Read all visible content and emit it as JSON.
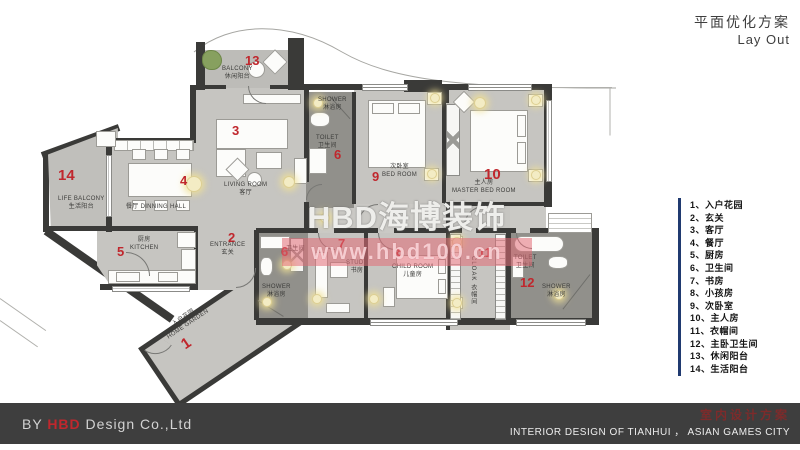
{
  "title": {
    "cn": "平面优化方案",
    "en": "Lay Out"
  },
  "watermark": {
    "brand": "HBD海博装饰",
    "url": "www.hbd100.cn"
  },
  "legend": {
    "items": [
      {
        "n": "1、",
        "t": "入户花园"
      },
      {
        "n": "2、",
        "t": "玄关"
      },
      {
        "n": "3、",
        "t": "客厅"
      },
      {
        "n": "4、",
        "t": "餐厅"
      },
      {
        "n": "5、",
        "t": "厨房"
      },
      {
        "n": "6、",
        "t": "卫生间"
      },
      {
        "n": "7、",
        "t": "书房"
      },
      {
        "n": "8、",
        "t": "小孩房"
      },
      {
        "n": "9、",
        "t": "次卧室"
      },
      {
        "n": "10、",
        "t": "主人房"
      },
      {
        "n": "11、",
        "t": "衣帽间"
      },
      {
        "n": "12、",
        "t": "主卧卫生间"
      },
      {
        "n": "13、",
        "t": "休闲阳台"
      },
      {
        "n": "14、",
        "t": "生活阳台"
      }
    ]
  },
  "rooms": {
    "home_garden": {
      "num": "1",
      "cn": "入户花园",
      "en": "HOME GARDEN"
    },
    "entrance": {
      "num": "2",
      "en": "ENTRANCE",
      "cn": "玄关"
    },
    "living": {
      "num": "3",
      "en": "LIVING ROOM",
      "cn": "客厅"
    },
    "dining": {
      "num": "4",
      "cn": "餐厅",
      "en": "DINNING HALL"
    },
    "kitchen": {
      "num": "5",
      "cn": "厨房",
      "en": "KITCHEN"
    },
    "toilet_top": {
      "num": "6",
      "en": "TOILET",
      "cn": "卫生间",
      "shower_en": "SHOWER",
      "shower_cn": "淋浴房"
    },
    "toilet_mid": {
      "num": "6",
      "en": "TOILET",
      "cn": "卫生间",
      "shower_en": "SHOWER",
      "shower_cn": "淋浴房"
    },
    "study": {
      "num": "7",
      "en": "STUDY",
      "cn": "书房"
    },
    "child": {
      "num": "8",
      "en": "CHILD ROOM",
      "cn": "儿童房"
    },
    "bedroom": {
      "num": "9",
      "cn": "次卧室",
      "en": "BED ROOM"
    },
    "master": {
      "num": "10",
      "cn": "主人房",
      "en": "MASTER BED ROOM"
    },
    "cloak": {
      "num": "11",
      "en": "CLOAK",
      "cn": "衣帽间"
    },
    "master_toilet": {
      "num": "12",
      "en": "TOILET",
      "cn": "卫生间",
      "shower_en": "SHOWER",
      "shower_cn": "淋浴房"
    },
    "balcony": {
      "num": "13",
      "en": "BALCONY",
      "cn": "休闲阳台"
    },
    "life_balcony": {
      "num": "14",
      "en": "LIFE BALCONY",
      "cn": "生活阳台"
    }
  },
  "footer": {
    "by": "BY ",
    "brand": "HBD",
    "company": " Design Co.,Ltd",
    "cn": "室内设计方案",
    "en": "INTERIOR DESIGN OF TIANHUI ， ASIAN GAMES CITY"
  },
  "colors": {
    "accent_red": "#c0272d",
    "wall": "#3a3a38",
    "floor": "#c6c5c1",
    "bath_floor": "#91908b",
    "legend_bar": "#203a70",
    "footer_bg": "#3e3e3e",
    "watermark_pink": "#e26c76"
  }
}
